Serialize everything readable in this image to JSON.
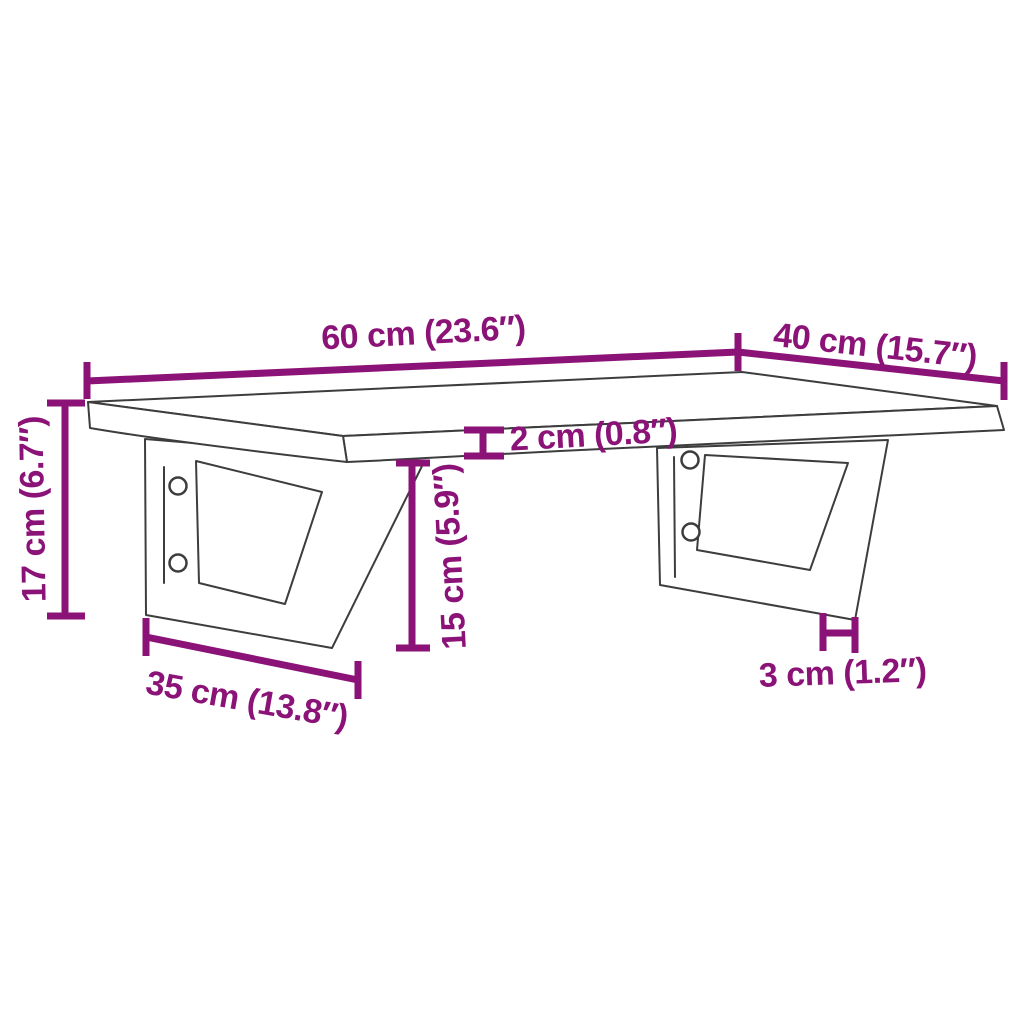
{
  "figure": {
    "description": "Technical dimension diagram of a wall-mounted shelf board supported by two trapezoid steel wall brackets, each bracket with two screw holes",
    "background_color": "#ffffff",
    "drawing_line_color": "#3d3d3d",
    "dimension_color": "#8B1277"
  },
  "dimensions": {
    "board_width": {
      "value_cm": 60,
      "value_inch": 23.6,
      "label": "60 cm (23.6″)"
    },
    "board_depth": {
      "value_cm": 40,
      "value_inch": 15.7,
      "label": "40 cm (15.7″)"
    },
    "total_height": {
      "value_cm": 17,
      "value_inch": 6.7,
      "label": "17 cm (6.7″)"
    },
    "board_thickness": {
      "value_cm": 2,
      "value_inch": 0.8,
      "label": "2 cm (0.8″)"
    },
    "bracket_height": {
      "value_cm": 15,
      "value_inch": 5.9,
      "label": "15 cm (5.9″)"
    },
    "bracket_depth": {
      "value_cm": 35,
      "value_inch": 13.8,
      "label": "35 cm (13.8″)"
    },
    "bracket_arm_width": {
      "value_cm": 3,
      "value_inch": 1.2,
      "label": "3 cm (1.2″)"
    }
  }
}
